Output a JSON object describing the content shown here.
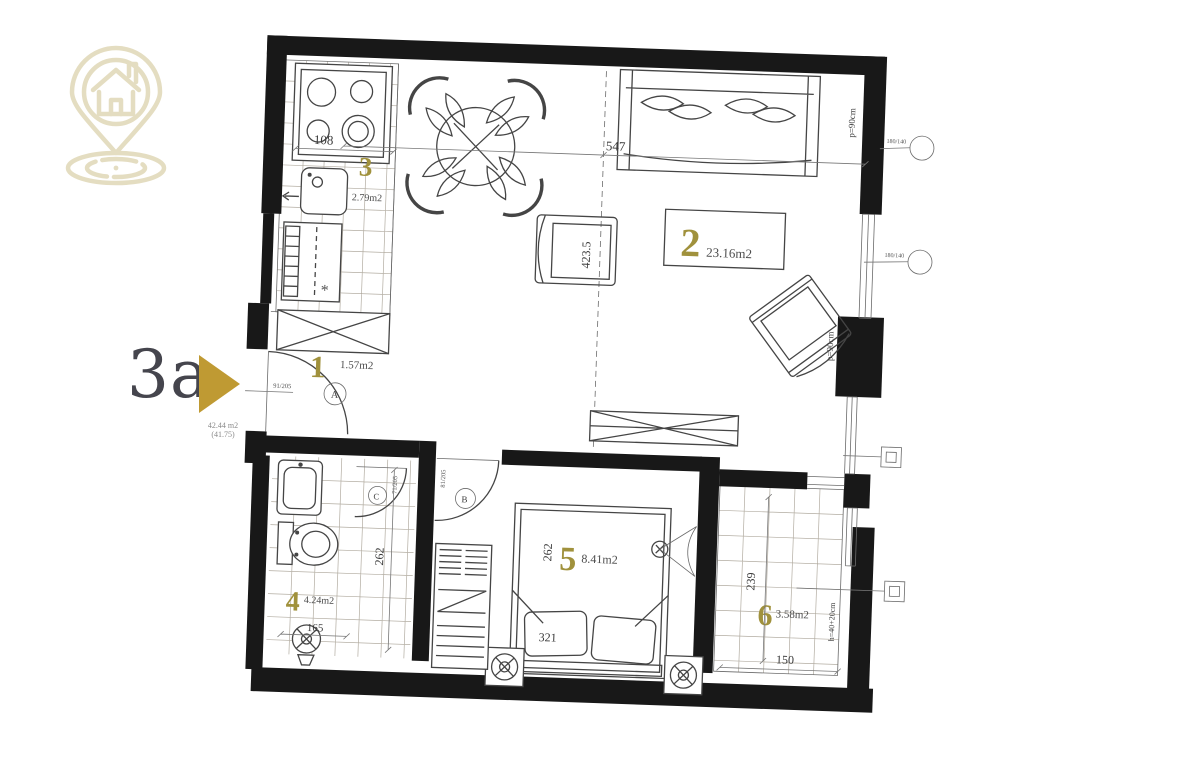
{
  "brand": {
    "logo": "house-location-pin",
    "unit_code": "3a",
    "total_area": "42.44 m2",
    "net_area": "(41.75)"
  },
  "colors": {
    "accent_gold": "#bf9a33",
    "room_number_gold": "#a0913c",
    "logo_beige": "#e4ddc1",
    "wall_black": "#181818"
  },
  "rooms": [
    {
      "number": "1",
      "area": "1.57m2"
    },
    {
      "number": "2",
      "area": "23.16m2"
    },
    {
      "number": "3",
      "area": "2.79m2"
    },
    {
      "number": "4",
      "area": "4.24m2"
    },
    {
      "number": "5",
      "area": "8.41m2"
    },
    {
      "number": "6",
      "area": "3.58m2"
    }
  ],
  "dimensions": {
    "kitchen_counter": "108",
    "living_width": "547",
    "living_depth": "423.5",
    "bath_depth": "262",
    "bath_width": "165",
    "bed_depth": "262",
    "bed_width": "321",
    "terrace_depth": "239",
    "terrace_width": "150"
  },
  "annotations": {
    "parapet_top": "p=90cm",
    "parapet_right": "p=90cm",
    "terrace_parapet": "h=40+20cm",
    "door_a_mark": "A",
    "door_a_size": "91/205",
    "door_b_mark": "B",
    "door_b_size": "81/205",
    "door_c_mark": "C",
    "door_c_size": "71/205",
    "window_tag_1": "180/140",
    "window_tag_2": "180/140"
  }
}
